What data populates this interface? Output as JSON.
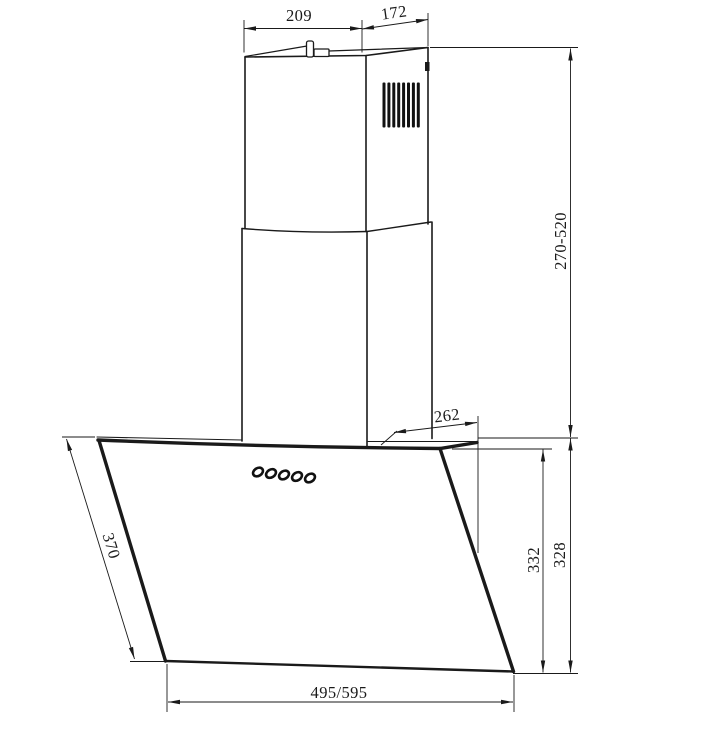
{
  "drawing": {
    "dimensions": {
      "chimney_top_width": "209",
      "chimney_top_depth": "172",
      "chimney_height_range": "270-520",
      "hood_top_depth": "262",
      "front_glass_height": "332",
      "body_height": "328",
      "glass_panel_length": "370",
      "width_variants": "495/595"
    },
    "colors": {
      "line": "#1a1a1a",
      "background": "#ffffff"
    },
    "controls": {
      "button_count": 5
    },
    "vent": {
      "slat_count": 8
    }
  }
}
